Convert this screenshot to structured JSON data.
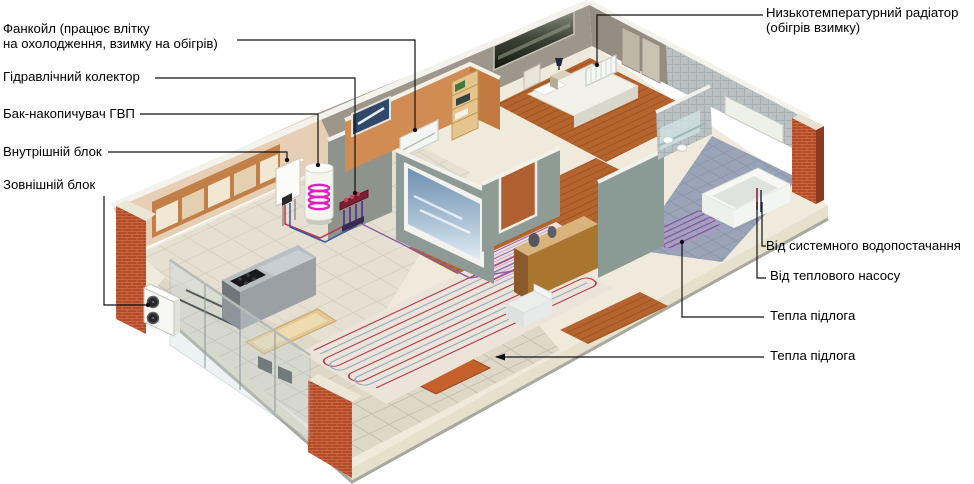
{
  "labels": {
    "fancoil": "Фанкойл (працює влітку\nна охолодження, взимку на обігрів)",
    "hydraulic_collector": "Гідравлічний колектор",
    "dhw_storage_tank": "Бак-накопичувач ГВП",
    "indoor_unit": "Внутрішній блок",
    "outdoor_unit": "Зовнішній блок",
    "low_temp_radiator": "Низькотемпературний радіатор\n(обігрів взимку)",
    "from_water_supply": "Від системного водопостачання",
    "from_heat_pump": "Від теплового насосу",
    "warm_floor_bathroom": "Тепла підлога",
    "warm_floor_living": "Тепла підлога"
  },
  "colors": {
    "background": "#ffffff",
    "label_text": "#000000",
    "callout_line": "#111111",
    "brick": "#b44b28",
    "slab": "#efeadb",
    "wall_orange": "#d18c54",
    "wall_gray_green": "#8f9b95",
    "wall_taupe": "#9d968b",
    "bath_tile": "#bac1c3",
    "wood_floor": "#b5642e",
    "heating_pipe_red": "#b13b52",
    "heating_pipe_blue": "#93acc2",
    "heating_pipe_purple": "#9a5fae",
    "tank_coil_magenta": "#e11fc4"
  }
}
